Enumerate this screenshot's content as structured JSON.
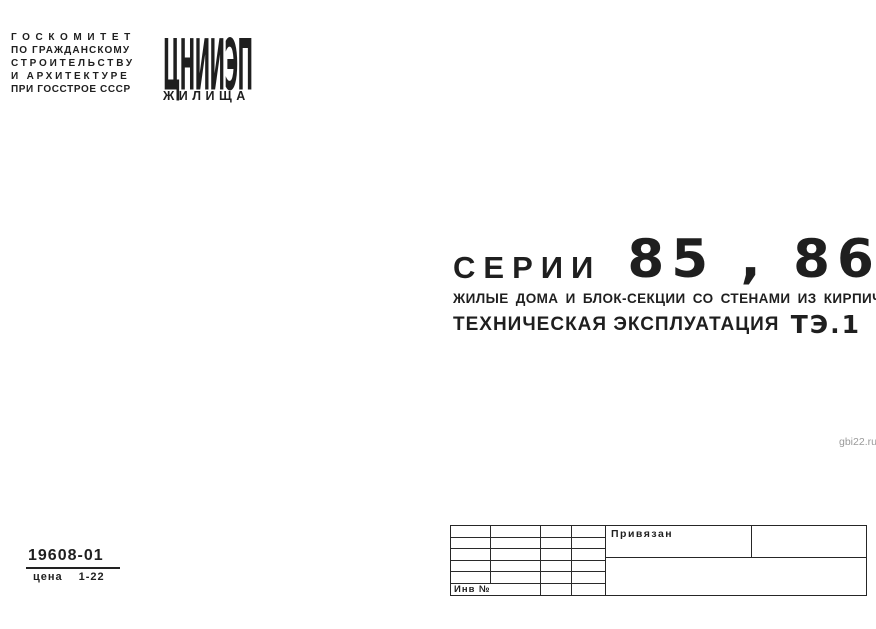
{
  "document": {
    "organization": {
      "lines": [
        "ГОСКОМИТЕТ",
        "ПО ГРАЖДАНСКОМУ",
        "СТРОИТЕЛЬСТВУ",
        "И АРХИТЕКТУРЕ",
        "ПРИ ГОССТРОЕ СССР"
      ]
    },
    "logo": {
      "name": "ЦНИИЭП",
      "subtitle": "ЖИЛИЩА"
    },
    "title": {
      "series_label": "СЕРИИ",
      "series_numbers": "85 , 86",
      "subtitle": "ЖИЛЫЕ ДОМА И БЛОК-СЕКЦИИ СО СТЕНАМИ ИЗ КИРПИЧА",
      "doc_type": "ТЕХНИЧЕСКАЯ ЭКСПЛУАТАЦИЯ",
      "doc_code": "ТЭ.1"
    },
    "watermark": "gbi22.ru",
    "footer": {
      "catalog_number": "19608-01",
      "price_label": "цена",
      "price_value": "1-22"
    },
    "stamp": {
      "binding_label": "Привязан",
      "inventory_label": "Инв №"
    }
  },
  "colors": {
    "ink": "#1f1f1f",
    "paper": "#ffffff",
    "watermark_gray": "#9a9a9a"
  }
}
